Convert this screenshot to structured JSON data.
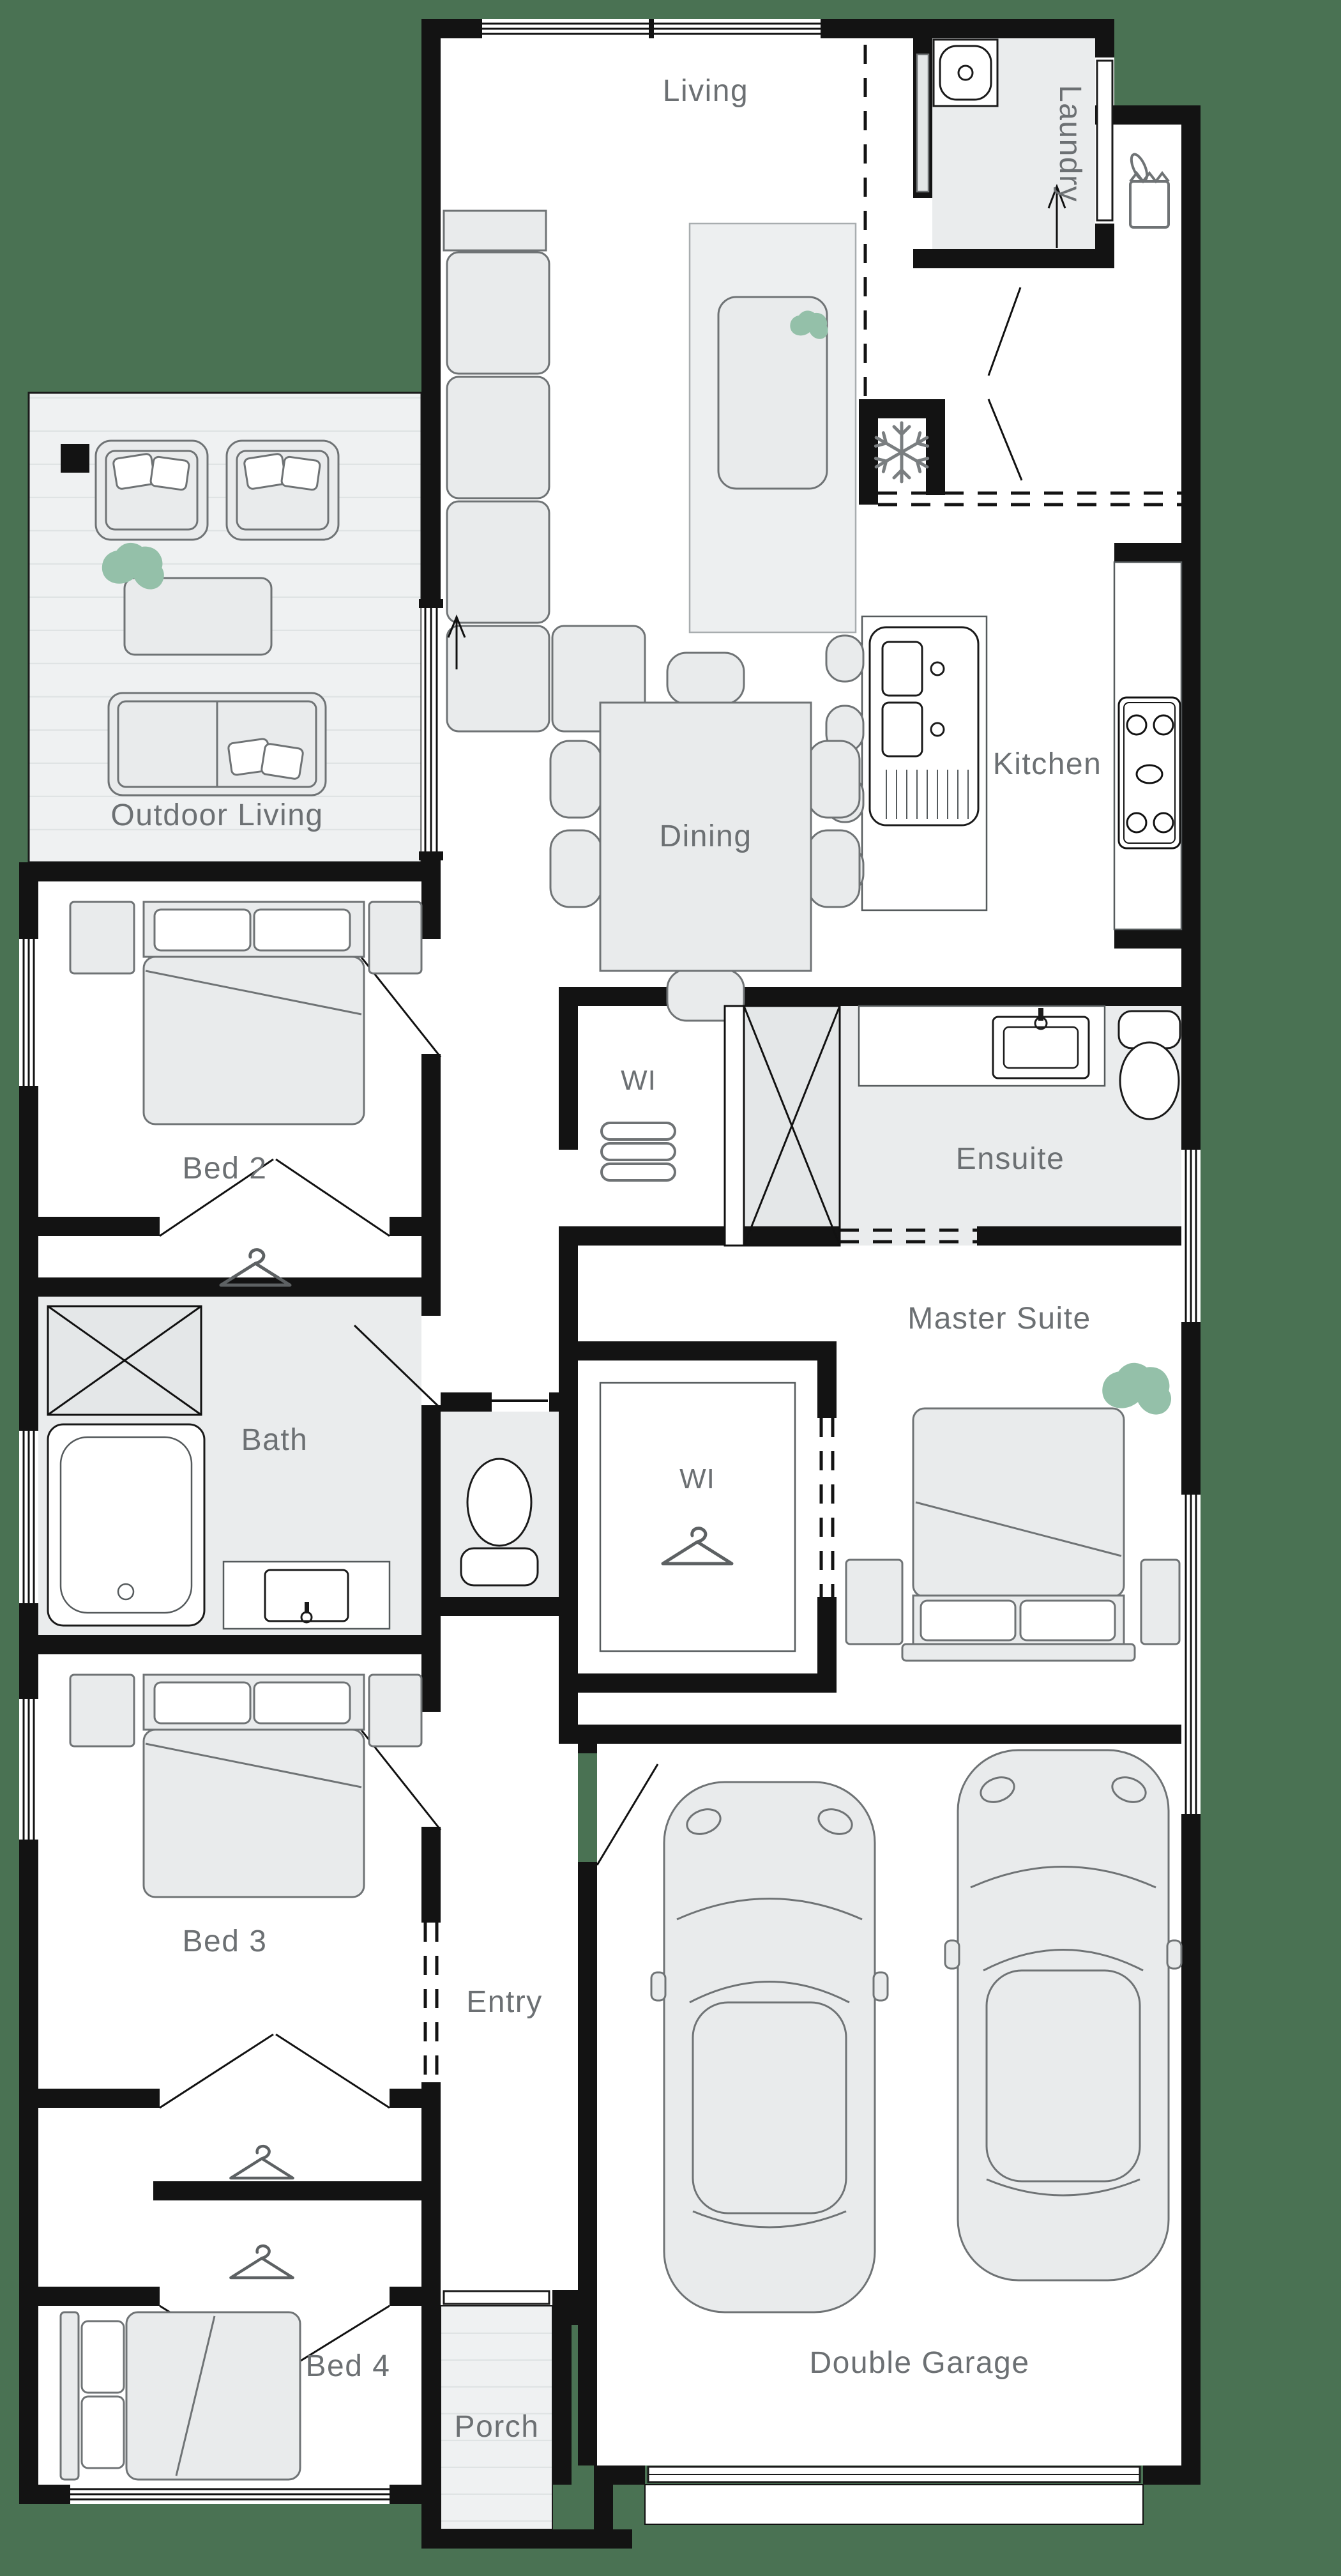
{
  "plan": {
    "background_color": "#4A7253",
    "wall_color": "#131313",
    "floor_color": "#FFFFFF",
    "wet_area_color": "#EAECED",
    "deck_color": "#EFF1F2",
    "furniture_fill": "#E9EBEC",
    "furniture_stroke": "#6F7375",
    "label_color": "#6C7073",
    "plant_color": "#94C0A9"
  },
  "rooms": {
    "living": "Living",
    "laundry": "Laundry",
    "outdoor_living": "Outdoor Living",
    "dining": "Dining",
    "kitchen": "Kitchen",
    "bed2": "Bed 2",
    "linen_wi": "WI",
    "ensuite": "Ensuite",
    "master_suite": "Master Suite",
    "master_wi": "WI",
    "bath": "Bath",
    "bed3": "Bed 3",
    "entry": "Entry",
    "bed4": "Bed 4",
    "porch": "Porch",
    "garage": "Double Garage"
  },
  "icons": {
    "fridge": "snowflake",
    "pantry": "grocery-bag",
    "wardrobe": "coat-hanger",
    "linen": "towel-stack",
    "plant": "leaf-cluster",
    "entry_direction": "arrow-up",
    "laundry_exit": "arrow-up"
  }
}
